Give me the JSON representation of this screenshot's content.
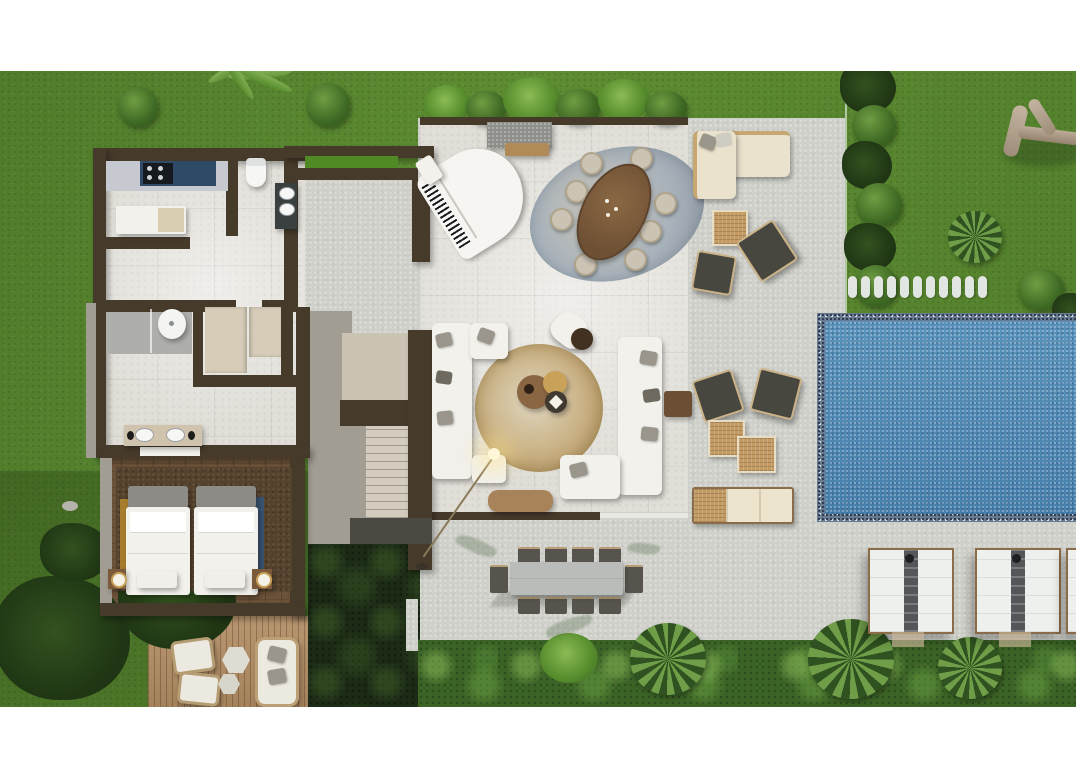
{
  "document": {
    "title": "Villa ground-floor plan — top-down 3D render",
    "type": "architectural-render",
    "visible_text": "none"
  },
  "palette": {
    "grass": "#5d8c32",
    "concrete": "#cfd0ca",
    "interior": "#e0ded7",
    "wall": "#463a2b",
    "ledge": "#a29d93",
    "wood": "#6b5238",
    "rugbed": "#55422d",
    "goldband": "#b5862e",
    "blueband": "#34557a",
    "deck": "#b28d64",
    "poolborder": "#6b7b90",
    "poolwater": "#4d8ab6",
    "white": "#f2f1ec",
    "cream": "#eae2cc",
    "cushion": "#9b968b",
    "cushiondark": "#6e6a60",
    "rattan": "#c49a63",
    "woodtable": "#8a6642",
    "goldaccent": "#c9a158",
    "counter": "#c6cad0",
    "appliance": "#2e4a66",
    "fixture": "#3a3f3f",
    "chairdark": "#47463f",
    "chairtrim": "#cbb389",
    "stone": "#e2e6e2",
    "lounger": "#eef0ee",
    "towel": "#54565a",
    "frame": "#8a6c48",
    "tablegray": "#b9bcb8",
    "chairgray": "#57544e",
    "bench": "#cbc3b4",
    "steps": "#d3ccbf",
    "stepline": "#a39a89",
    "glow": "#ffe9a8"
  },
  "roomLabels": {
    "garden": "Garden lawn",
    "kitchen": "Kitchen",
    "bathroomTop": "Bathroom (WC + vanity)",
    "bathroomMid": "Bathroom (shower + double vanity)",
    "closet": "Walk-in closet",
    "hallway": "Hallway",
    "bedroom": "Bedroom with twin beds",
    "courtyard": "Inner planted courtyard",
    "entry": "Entry walkway",
    "greatRoom": "Open living / dining room",
    "staircase": "Staircase",
    "terrace": "Outdoor lounge terrace",
    "pool": "Swimming pool",
    "poolDeck": "Pool deck",
    "woodDeck": "Private wood deck",
    "plantBed": "Tropical planting bed"
  },
  "furnitureLabels": {
    "piano": "White grand piano",
    "diningTable": "Oval wood dining table with 8 chairs",
    "sofaLeft": "L-shaped sofa (left)",
    "sofaRight": "L-shaped sofa (right)",
    "armchair": "Lounge armchair with side table",
    "coffeeTables": "Nesting round coffee tables",
    "arcLamp": "Arc floor lamp",
    "consoleBench": "Wood console bench",
    "outdoorSofa": "Outdoor cream L-sofa",
    "wickerChairs": "Dark wicker armchairs",
    "rattanTables": "Rattan cube tables",
    "poolBench": "Poolside bench with cushions",
    "outdoorDining": "10-seat outdoor dining table",
    "loungers": "Sun lounger pair with towel strip",
    "twinBeds": "Twin beds with white duvets",
    "deckSeating": "Deck lounge chairs, hex tables and loveseat",
    "steppingStones": "Stepping-stone path",
    "branch": "Driftwood branch sculpture",
    "agave": "Agave plant"
  },
  "counts": {
    "diningChairs": 8,
    "outdoorDiningSeats": 10,
    "loungerPairs": 3,
    "steppingStonesTopRow": 11,
    "beds": 2,
    "bathrooms": 2
  }
}
